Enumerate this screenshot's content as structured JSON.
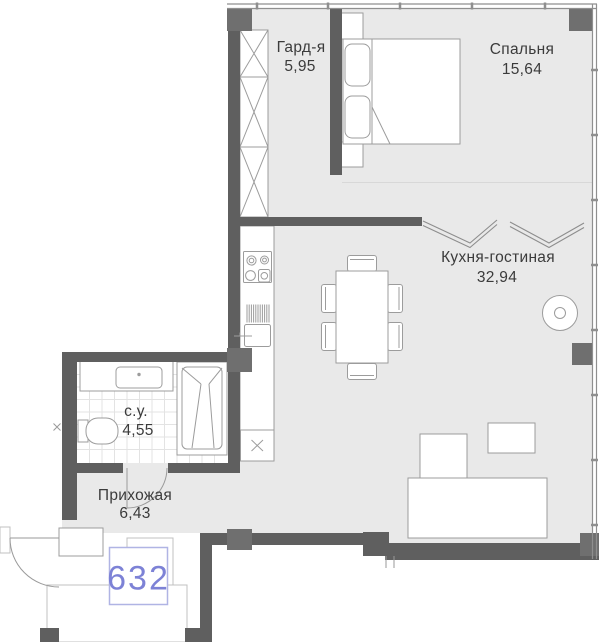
{
  "plan": {
    "unit_badge": {
      "number": "632"
    },
    "rooms": {
      "wardrobe": {
        "name": "Гард-я",
        "area": "5,95"
      },
      "bedroom": {
        "name": "Спальня",
        "area": "15,64"
      },
      "kitchen_living": {
        "name": "Кухня-гостиная",
        "area": "32,94"
      },
      "bathroom": {
        "name": "с.у.",
        "area": "4,55"
      },
      "hallway": {
        "name": "Прихожая",
        "area": "6,43"
      }
    },
    "colors": {
      "wall": "#5f5f5f",
      "column": "#6f6f6f",
      "floor": "#e9e9e9",
      "furniture_outline": "#9c9c9c",
      "facade": "#8f8f8f",
      "label_text": "#3b3b3b",
      "badge_border": "#b0b4e4",
      "badge_text": "#7d82d6",
      "outside_outline": "#c0c0c0"
    }
  }
}
